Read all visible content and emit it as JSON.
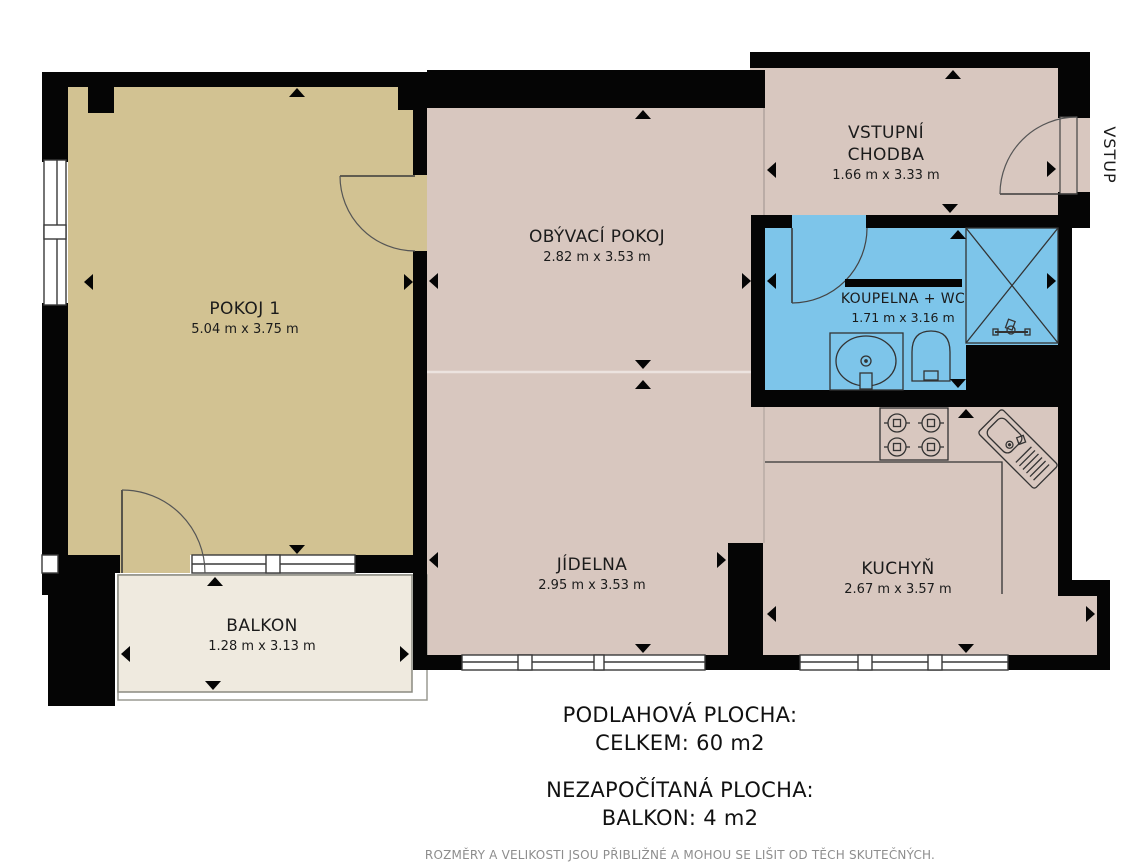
{
  "title": "Floor plan – apartment 60 m2",
  "rooms": [
    {
      "id": "pokoj1",
      "name": "POKOJ 1",
      "dims": "5.04 m x 3.75 m"
    },
    {
      "id": "obyvaci",
      "name": "OBÝVACÍ POKOJ",
      "dims": "2.82 m x 3.53 m"
    },
    {
      "id": "chodba",
      "name": "VSTUPNÍ CHODBA",
      "dims": "1.66 m x 3.33 m"
    },
    {
      "id": "koupelna",
      "name": "KOUPELNA + WC",
      "dims": "1.71 m x 3.16 m"
    },
    {
      "id": "jidelna",
      "name": "JÍDELNA",
      "dims": "2.95 m x 3.53 m"
    },
    {
      "id": "kuchyn",
      "name": "KUCHYŇ",
      "dims": "2.67 m x 3.57 m"
    },
    {
      "id": "balkon",
      "name": "BALKON",
      "dims": "1.28 m x 3.13 m"
    }
  ],
  "entrance_label": "VSTUP",
  "summary": {
    "floor_area_title": "PODLAHOVÁ PLOCHA:",
    "floor_area_value": "CELKEM: 60 m2",
    "excluded_title": "NEZAPOČÍTANÁ PLOCHA:",
    "excluded_value": "BALKON: 4 m2",
    "disclaimer": "ROZMĚRY A VELIKOSTI JSOU PŘIBLIŽNÉ A MOHOU SE LIŠIT OD TĚCH SKUTEČNÝCH."
  },
  "colors": {
    "wall": "#050505",
    "room_beige": "#d8c7bf",
    "room_tan": "#d2c292",
    "bathroom_blue": "#7dc5ea",
    "balcony_cream": "#efeadf",
    "line": "#3a3a3a",
    "disclaimer_gray": "#8d8d8d"
  }
}
